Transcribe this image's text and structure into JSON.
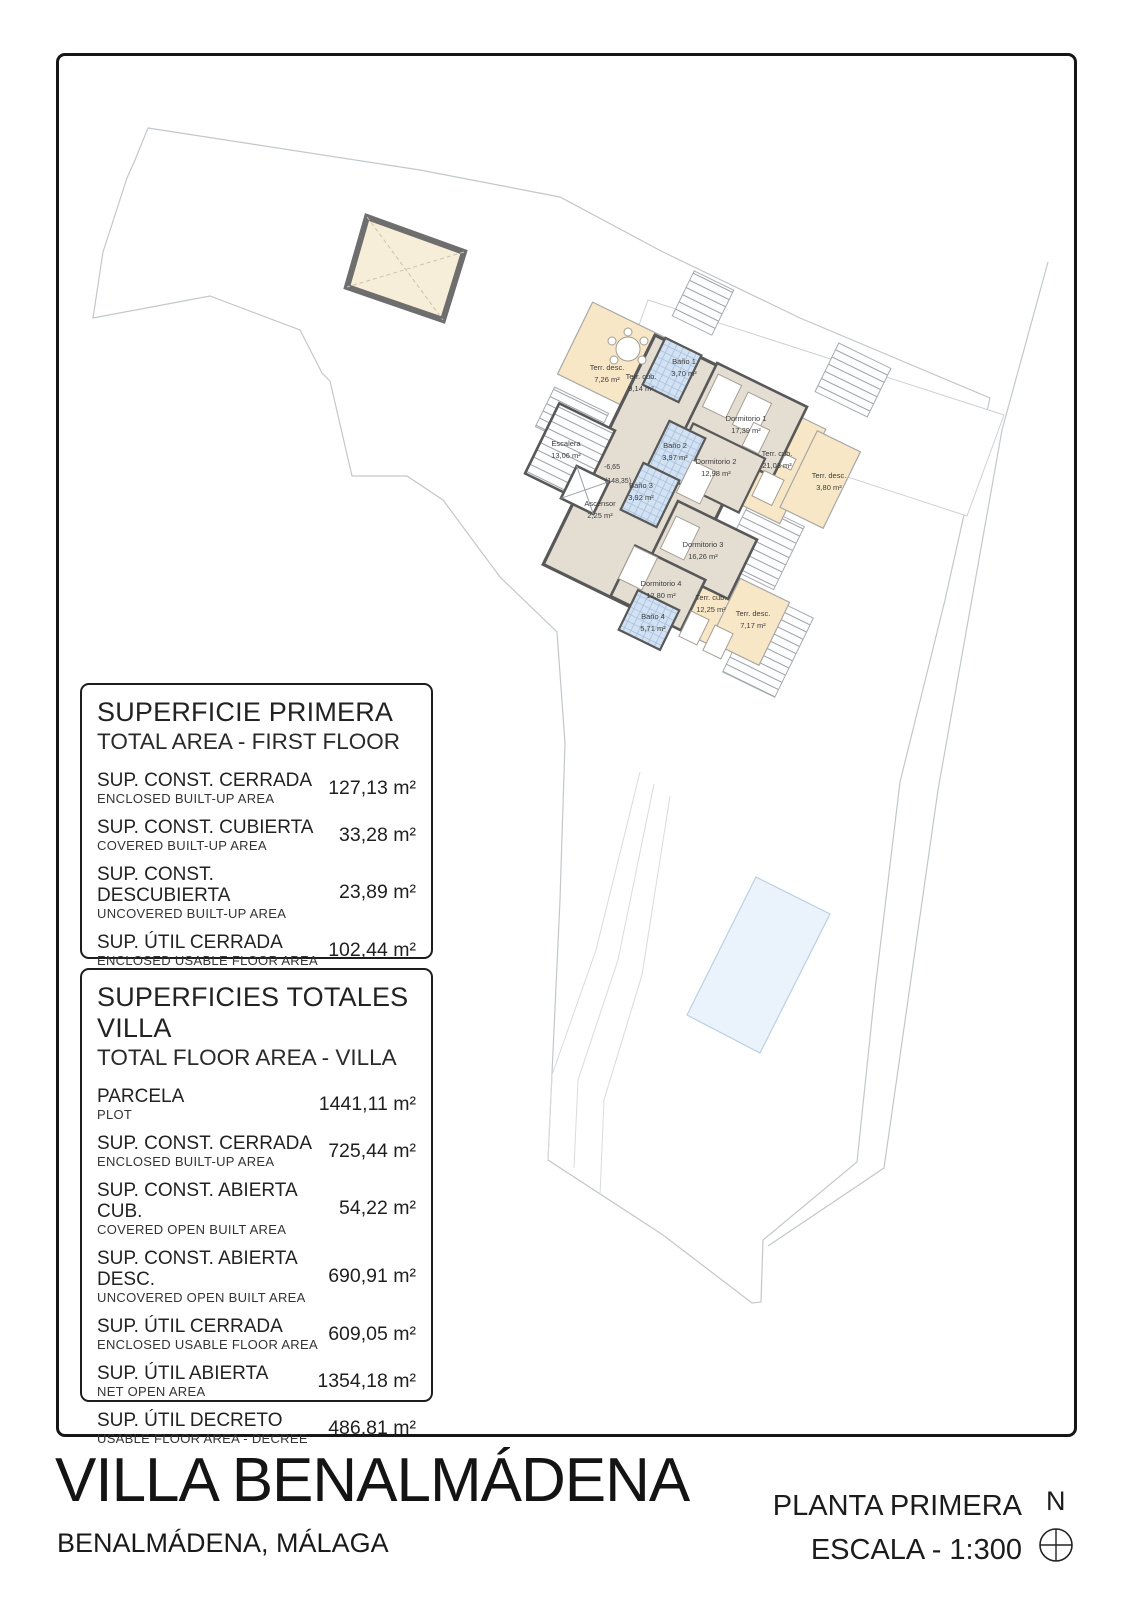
{
  "title_block": {
    "title": "VILLA BENALMÁDENA",
    "location": "BENALMÁDENA, MÁLAGA",
    "sheet_name": "PLANTA PRIMERA",
    "scale_label": "ESCALA - 1:300",
    "north_label": "N"
  },
  "tables": [
    {
      "title": "SUPERFICIE PRIMERA",
      "subtitle": "TOTAL AREA - FIRST FLOOR",
      "rows": [
        {
          "label": "SUP. CONST. CERRADA",
          "sublabel": "ENCLOSED BUILT-UP AREA",
          "value": "127,13 m²"
        },
        {
          "label": "SUP. CONST. CUBIERTA",
          "sublabel": "COVERED BUILT-UP AREA",
          "value": "33,28 m²"
        },
        {
          "label": "SUP. CONST. DESCUBIERTA",
          "sublabel": "UNCOVERED BUILT-UP AREA",
          "value": "23,89 m²"
        },
        {
          "label": "SUP. ÚTIL CERRADA",
          "sublabel": "ENCLOSED USABLE FLOOR AREA",
          "value": "102,44 m²"
        }
      ]
    },
    {
      "title": "SUPERFICIES TOTALES VILLA",
      "subtitle": "TOTAL FLOOR AREA - VILLA",
      "rows": [
        {
          "label": "PARCELA",
          "sublabel": "PLOT",
          "value": "1441,11 m²"
        },
        {
          "label": "SUP. CONST. CERRADA",
          "sublabel": "ENCLOSED BUILT-UP AREA",
          "value": "725,44 m²"
        },
        {
          "label": "SUP. CONST. ABIERTA CUB.",
          "sublabel": "COVERED OPEN BUILT AREA",
          "value": "54,22 m²"
        },
        {
          "label": "SUP. CONST. ABIERTA DESC.",
          "sublabel": "UNCOVERED OPEN BUILT AREA",
          "value": "690,91 m²"
        },
        {
          "label": "SUP. ÚTIL CERRADA",
          "sublabel": "ENCLOSED USABLE FLOOR AREA",
          "value": "609,05 m²"
        },
        {
          "label": "SUP. ÚTIL ABIERTA",
          "sublabel": "NET OPEN AREA",
          "value": "1354,18 m²"
        },
        {
          "label": "SUP. ÚTIL DECRETO",
          "sublabel": "USABLE FLOOR AREA - DECREE",
          "value": "486,81 m²"
        }
      ]
    }
  ],
  "plan": {
    "level": {
      "value": "-6,65",
      "datum": "(148,35)"
    },
    "rooms": [
      {
        "name": "Terr. desc.",
        "area": "7,26 m²"
      },
      {
        "name": "Terr. cub.",
        "area": "9,14 m²"
      },
      {
        "name": "Baño 1",
        "area": "3,70 m²"
      },
      {
        "name": "Dormitorio 1",
        "area": "17,39 m²"
      },
      {
        "name": "Escalera",
        "area": "13,06 m²"
      },
      {
        "name": "Baño 2",
        "area": "3,97 m²"
      },
      {
        "name": "Dormitorio 2",
        "area": "12,98 m²"
      },
      {
        "name": "Terr. cub.",
        "area": "21,03 m²"
      },
      {
        "name": "Terr. desc.",
        "area": "3,80 m²"
      },
      {
        "name": "Ascensor",
        "area": "2,25 m²"
      },
      {
        "name": "Baño 3",
        "area": "3,92 m²"
      },
      {
        "name": "Dormitorio 3",
        "area": "16,26 m²"
      },
      {
        "name": "Dormitorio 4",
        "area": "12,80 m²"
      },
      {
        "name": "Baño 4",
        "area": "5,71 m²"
      },
      {
        "name": "Terr. cub.",
        "area": "12,25 m²"
      },
      {
        "name": "Terr. desc.",
        "area": "7,17 m²"
      }
    ]
  },
  "colors": {
    "frame": "#161616",
    "wall": "#585858",
    "room_floor": "#e3ddd2",
    "terrace": "#f8e7c6",
    "bathroom": "#d3e2f3",
    "pool": "#eaf3fc",
    "skylight": "#f6eed9",
    "boundary_line": "#c3c7cc"
  }
}
